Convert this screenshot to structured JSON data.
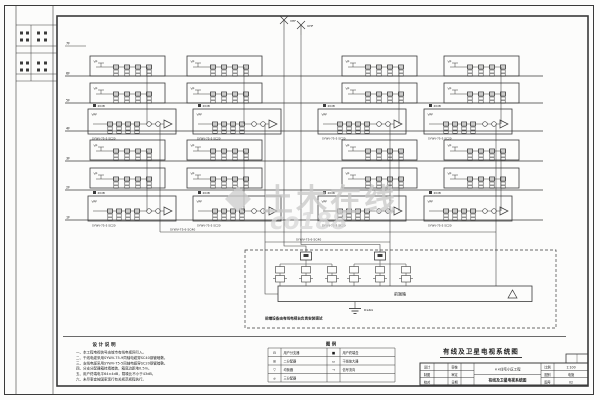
{
  "page": {
    "title": "有线及卫星电视系统图"
  },
  "watermark": {
    "brand": "土木在线",
    "site": "co188"
  },
  "antennas": {
    "left_label": "VHF",
    "right_label": "UHF"
  },
  "floors": [
    "7F",
    "6F",
    "5F",
    "4F",
    "3F",
    "2F",
    "1F"
  ],
  "boxes": {
    "std_label": "VP",
    "wide_label": "VPF",
    "wide_gain_label": "20dB",
    "branch_cable_label": "SYWV-75-5 SC20"
  },
  "riser_labels": [
    "SYWV-75-9 SC40",
    "SYWV-75-9 SC40"
  ],
  "headend": {
    "unit_label": "前端箱",
    "amp_note": "前端设备由有线电视台负责安装调试",
    "ground_label": "R≤4Ω"
  },
  "notes": {
    "title": "设 计 说 明",
    "lines": [
      "一、本工程电视信号由城市有线电视网引入。",
      "二、干线电缆采用SYWV-75-9同轴电缆穿SC40钢管暗敷。",
      "三、支线电缆采用SYWV-75-5同轴电缆穿SC20钢管暗敷。",
      "四、分支分配器箱挂墙暗装，箱底边距地0.5m。",
      "五、用户终端电平64±4dB，载噪比不小于43dB。",
      "六、未尽事宜按国家现行有关规范规程执行。"
    ]
  },
  "legend": {
    "title": "图 例",
    "rows": [
      {
        "sym1": "⊟",
        "name1": "用户分支器",
        "sym2": "■",
        "name2": "用户终端盒"
      },
      {
        "sym1": "⊞",
        "name1": "二分配器",
        "sym2": "▭",
        "name2": "干线放大器"
      },
      {
        "sym1": "▽",
        "name1": "均衡器",
        "sym2": "→",
        "name2": "信号流向"
      },
      {
        "sym1": "⌀",
        "name1": "三分配器",
        "sym2": "",
        "name2": ""
      }
    ]
  },
  "titleblock": {
    "left_rows": [
      [
        "设计",
        ""
      ],
      [
        "制图",
        ""
      ],
      [
        "校对",
        ""
      ]
    ],
    "mid_rows": [
      [
        "审核",
        ""
      ],
      [
        "审定",
        ""
      ],
      [
        "日期",
        ""
      ]
    ],
    "project_name": "××住宅小区工程",
    "drawing_name": "有线及卫星电视系统图",
    "scale_label": "比例",
    "scale_value": "1:100",
    "type_label": "图别",
    "type_value": "电施",
    "no_label": "图号",
    "no_value": "02"
  }
}
